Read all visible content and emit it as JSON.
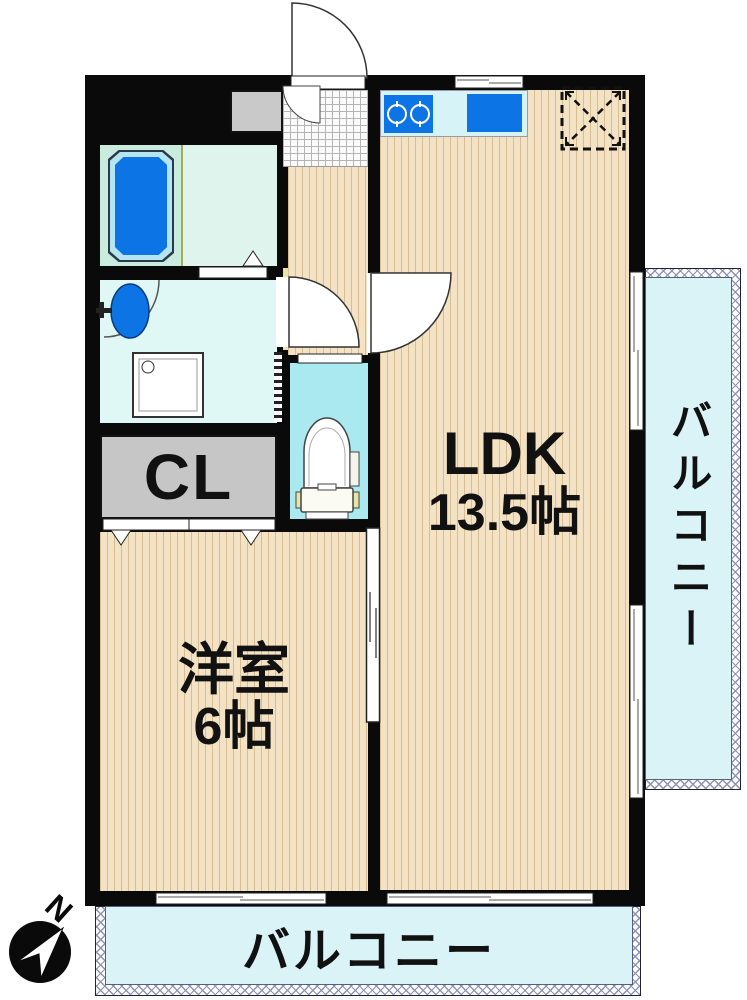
{
  "rooms": {
    "ldk": {
      "name": "LDK",
      "size": "13.5帖"
    },
    "western": {
      "name": "洋室",
      "size": "6帖"
    },
    "closet": {
      "name": "CL"
    }
  },
  "balconies": {
    "right": {
      "label": "バルコニー"
    },
    "bottom": {
      "label": "バルコニー"
    }
  },
  "compass": {
    "north": "N"
  },
  "icons": [
    "compass-icon",
    "bathtub-icon",
    "washbasin-icon",
    "washing-machine-pan-icon",
    "toilet-icon",
    "stove-icon",
    "sink-icon",
    "refrigerator-space-icon",
    "entrance-door-arc",
    "inner-door-arc",
    "washroom-door-arc",
    "ldk-door-arc",
    "bathroom-door-marker",
    "closet-door-markers",
    "toilet-sliding-door",
    "room-sliding-door",
    "window-icon",
    "balcony-railing"
  ],
  "colors": {
    "wall": "#0a0a0a",
    "wood": "#f3e2c4",
    "wood_line": "#d6bd92",
    "water_blue": "#0d74e6",
    "balcony_floor": "#d9f3f7",
    "toilet_floor": "#a9e9ef",
    "washroom_floor": "#e0f8f5",
    "bathroom_floor": "#dff4ec",
    "tub_area": "#c9ecdf",
    "tub_rim": "#b5e4f2",
    "counter": "#d6f3f8",
    "closet_gray": "#c6c6c6",
    "cabinet_gray": "#c9c9c9",
    "genkan_tile": "#fafafa",
    "accent_yellow": "#e9e3a6",
    "railing_line": "#8d93b5"
  }
}
